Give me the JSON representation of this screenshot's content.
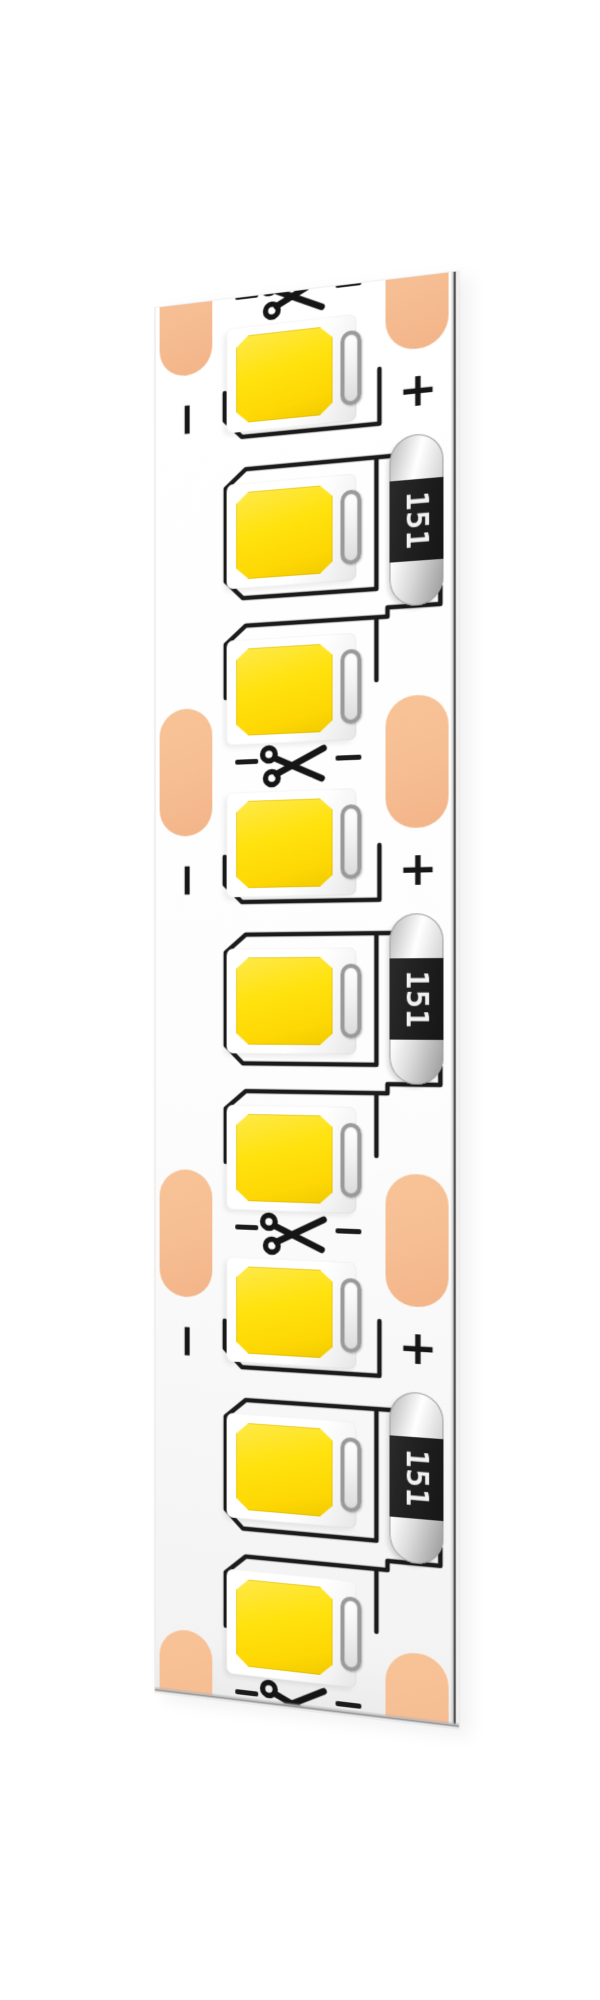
{
  "scene": {
    "subject": "White flexible LED strip (surface-mount LEDs) rendered at an angle, three cuttable segments visible",
    "background_color": "#ffffff"
  },
  "strip": {
    "pcb_color": "#ffffff",
    "solder_pad_color": "#f6bd92",
    "trace_color": "#1b1b1b",
    "led_phosphor_color": "#ffe20d",
    "led_package_color": "#ffffff",
    "resistor_body_color": "#1f1f1f",
    "cut_marks": {
      "icon": "scissors",
      "count": 4
    },
    "segments": [
      {
        "resistor_label": "151",
        "plus": "+",
        "minus": "−",
        "led_count": 3
      },
      {
        "resistor_label": "151",
        "plus": "+",
        "minus": "−",
        "led_count": 3
      },
      {
        "resistor_label": "151",
        "plus": "+",
        "minus": "−",
        "led_count": 3
      }
    ]
  }
}
